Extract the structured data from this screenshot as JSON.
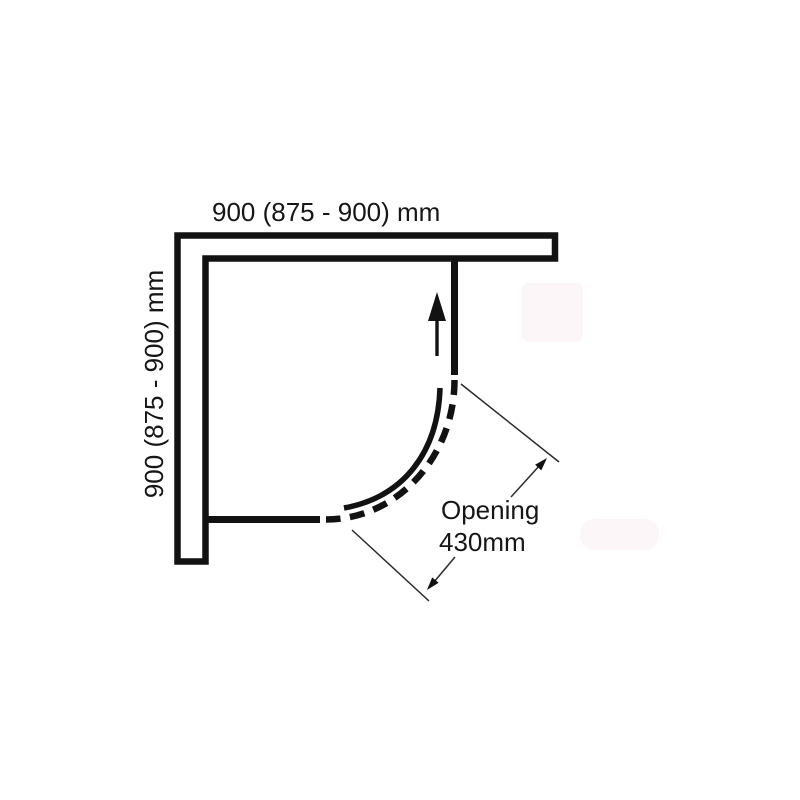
{
  "labels": {
    "top_dimension": "900 (875 - 900) mm",
    "left_dimension": "900 (875 - 900) mm",
    "opening_line1": "Opening",
    "opening_line2": "430mm"
  },
  "colors": {
    "background": "#ffffff",
    "drawing_line": "#121212",
    "thin_line": "#2b2b2b",
    "watermark": "#fcf6f8"
  },
  "icons": {
    "slide_direction": "up-arrow-icon",
    "dimension_upper": "arrow-up-right-icon",
    "dimension_lower": "arrow-down-left-icon"
  }
}
